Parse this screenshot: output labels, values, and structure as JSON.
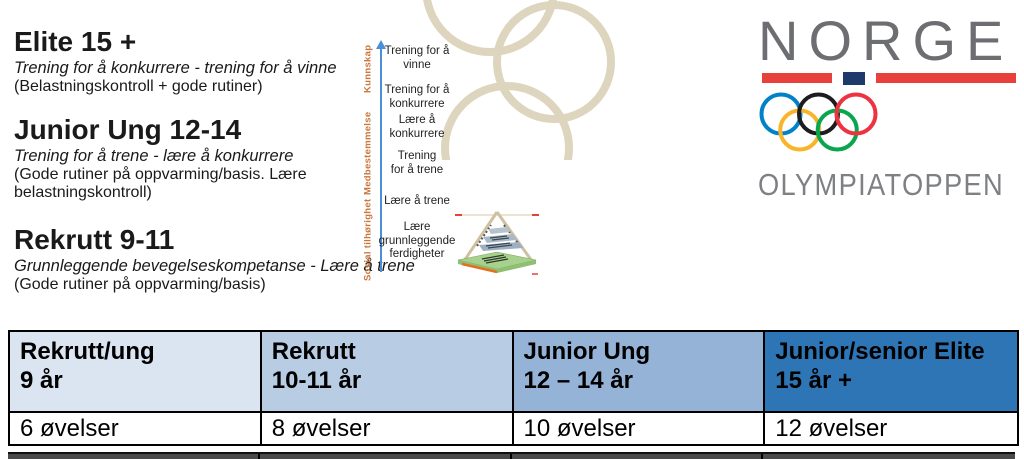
{
  "levels": [
    {
      "title": "Elite 15 +",
      "subtitle": "Trening for å konkurrere - trening for å vinne",
      "note": "(Belastningskontroll + gode rutiner)"
    },
    {
      "title": "Junior Ung 12-14",
      "subtitle": "Trening for å trene - lære å konkurrere",
      "note": "(Gode rutiner på oppvarming/basis. Lære\nbelastningskontroll)"
    },
    {
      "title": "Rekrutt 9-11",
      "subtitle": "Grunnleggende bevegelseskompetanse - Lære å trene",
      "note": "(Gode rutiner på oppvarming/basis)"
    }
  ],
  "ladder": {
    "axis_labels": [
      "Kunnskap",
      "Medbestemmelse",
      "Sosial tilhørighet"
    ],
    "axis_color": "#4a8fd8",
    "axis_label_color": "#c8763a",
    "stages": [
      "Trening for å\nvinne",
      "Trening for å\nkonkurrere",
      "Lære å\nkonkurrere",
      "Trening\nfor å trene",
      "Lære å trene",
      "Lære\ngrunnleggende\nferdigheter"
    ]
  },
  "watermark": {
    "color": "#ddd5bd"
  },
  "logo": {
    "country": "NORGE",
    "org": "OLYMPIATOPPEN",
    "country_color": "#6d6e71",
    "org_color": "#7e8083",
    "flag": {
      "red": "#e8403a",
      "navy": "#1d3a6b"
    },
    "rings": {
      "blue": "#0082c9",
      "black": "#1d1d1f",
      "red": "#ee3340",
      "yellow": "#f9b52a",
      "green": "#0aa64e"
    }
  },
  "table": {
    "columns": [
      {
        "header": "Rekrutt/ung\n9 år",
        "value": "6 øvelser",
        "header_bg": "#dbe5f1"
      },
      {
        "header": "Rekrutt\n10-11 år",
        "value": "8 øvelser",
        "header_bg": "#b8cce4"
      },
      {
        "header": "Junior Ung\n12 – 14 år",
        "value": "10 øvelser",
        "header_bg": "#95b3d7"
      },
      {
        "header": "Junior/senior Elite\n15 år +",
        "value": "12 øvelser",
        "header_bg": "#2e75b5"
      }
    ]
  }
}
